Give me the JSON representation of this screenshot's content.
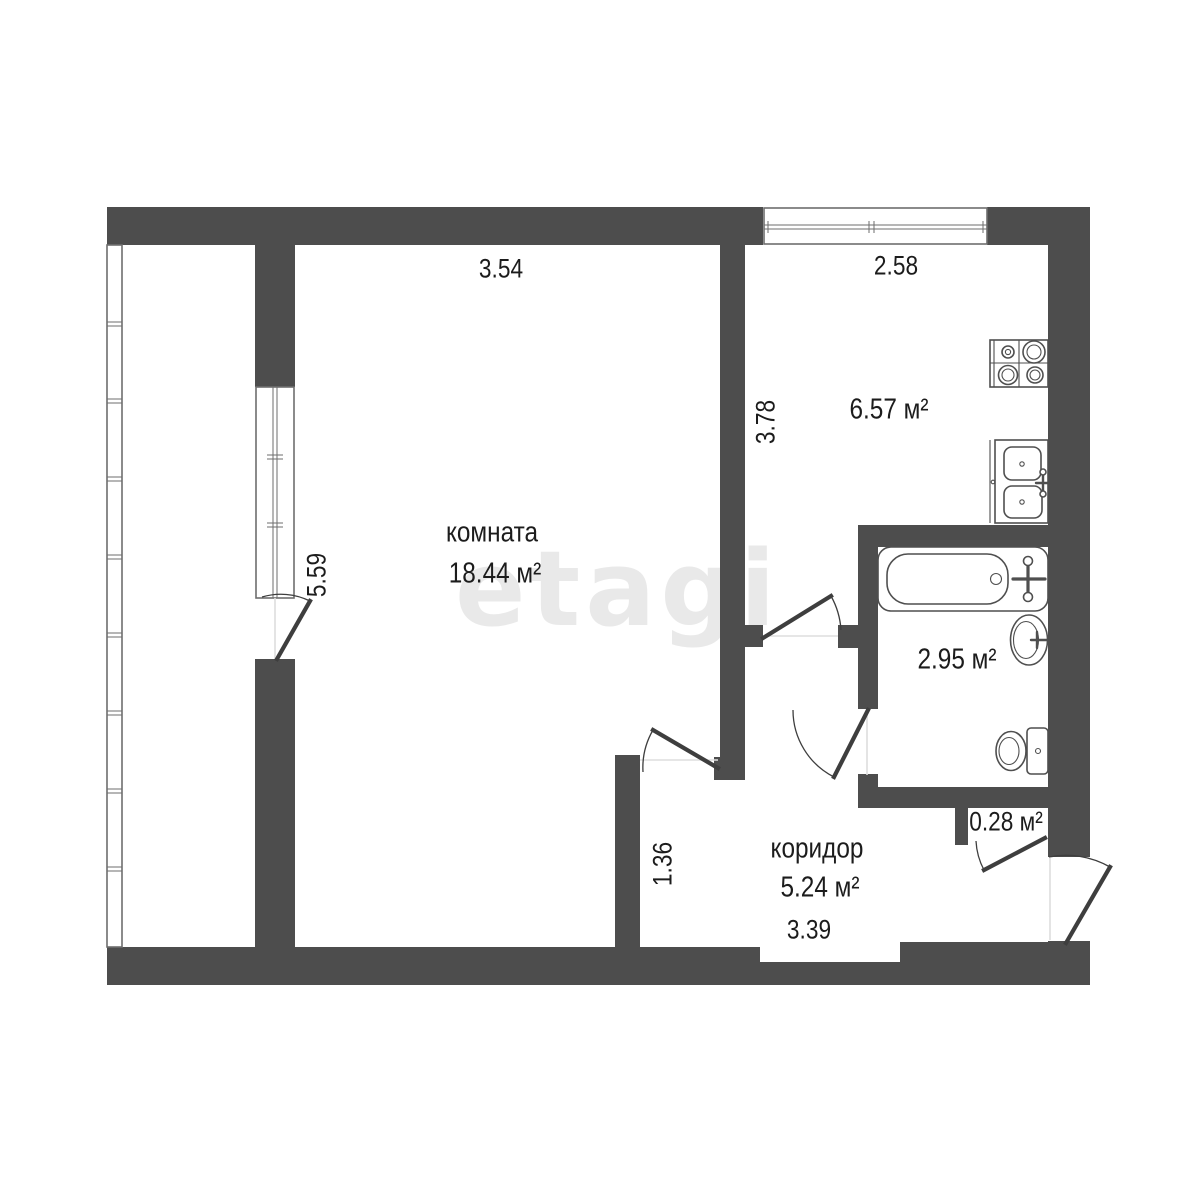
{
  "plan": {
    "watermark": "etagi",
    "colors": {
      "wall": "#4d4d4d",
      "line": "#4f4f4f",
      "window_line": "#6e6e6e",
      "text": "#1c1c1c",
      "watermark": "#e9e9e9",
      "background": "#ffffff"
    },
    "rooms": {
      "living": {
        "name": "комната",
        "area": "18.44 м²"
      },
      "kitchen": {
        "area": "6.57 м²"
      },
      "bathroom": {
        "area": "2.95 м²"
      },
      "corridor": {
        "name": "коридор",
        "area": "5.24 м²"
      },
      "closet": {
        "area": "0.28 м²"
      }
    },
    "dimensions": {
      "room_width": "3.54",
      "kitchen_width": "2.58",
      "kitchen_depth": "3.78",
      "room_depth": "5.59",
      "corridor_depth": "1.36",
      "corridor_width": "3.39"
    }
  }
}
